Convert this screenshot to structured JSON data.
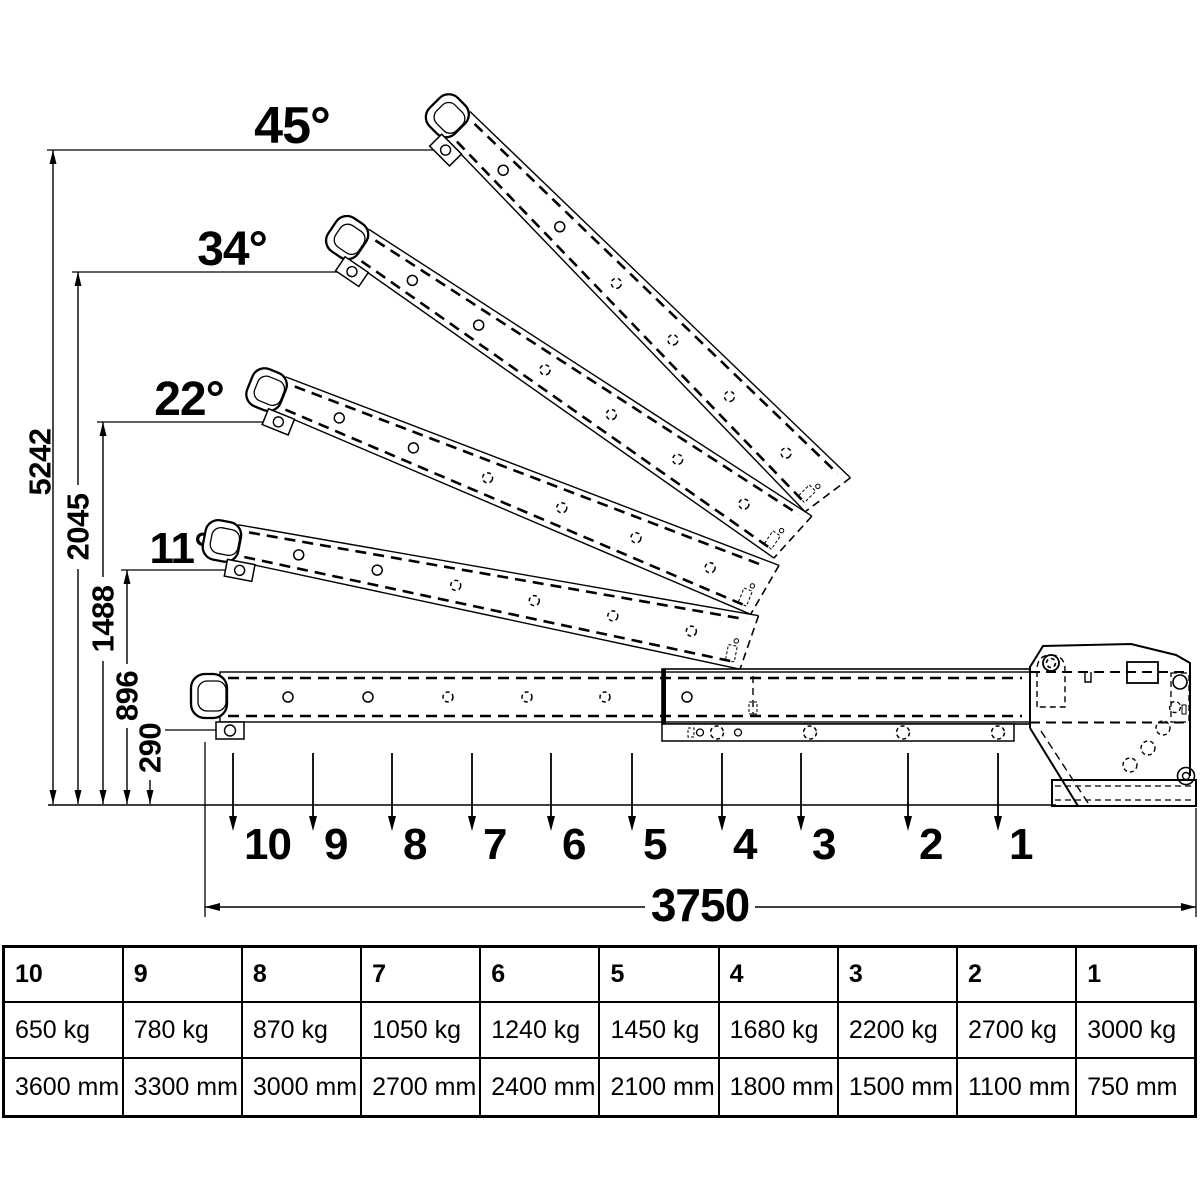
{
  "diagram": {
    "angle_labels": [
      "45°",
      "34°",
      "22°",
      "11°"
    ],
    "height_labels": [
      "5242",
      "2045",
      "1488",
      "896",
      "290"
    ],
    "position_labels": [
      "10",
      "9",
      "8",
      "7",
      "6",
      "5",
      "4",
      "3",
      "2",
      "1"
    ],
    "total_length_label": "3750"
  },
  "table": {
    "columns": [
      {
        "position": "10",
        "load": "650 kg",
        "reach": "3600 mm"
      },
      {
        "position": "9",
        "load": "780 kg",
        "reach": "3300 mm"
      },
      {
        "position": "8",
        "load": "870 kg",
        "reach": "3000 mm"
      },
      {
        "position": "7",
        "load": "1050 kg",
        "reach": "2700 mm"
      },
      {
        "position": "6",
        "load": "1240 kg",
        "reach": "2400 mm"
      },
      {
        "position": "5",
        "load": "1450 kg",
        "reach": "2100 mm"
      },
      {
        "position": "4",
        "load": "1680 kg",
        "reach": "1800 mm"
      },
      {
        "position": "3",
        "load": "2200 kg",
        "reach": "1500 mm"
      },
      {
        "position": "2",
        "load": "2700 kg",
        "reach": "1100 mm"
      },
      {
        "position": "1",
        "load": "3000 kg",
        "reach": "750 mm"
      }
    ]
  },
  "colors": {
    "line": "#000000",
    "background": "#ffffff"
  }
}
